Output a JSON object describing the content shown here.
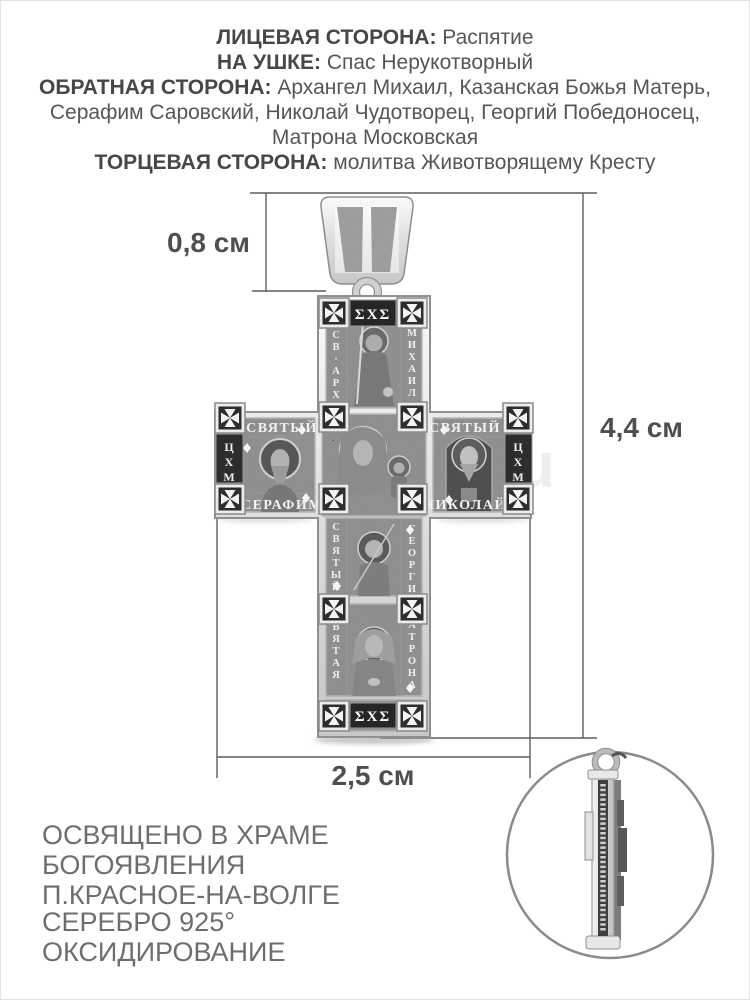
{
  "specs": {
    "lines": [
      {
        "label": "ЛИЦЕВАЯ СТОРОНА:",
        "value": " Распятие"
      },
      {
        "label": "НА УШКЕ:",
        "value": " Спас Нерукотворный"
      },
      {
        "label": "ОБРАТНАЯ СТОРОНА:",
        "value": " Архангел Михаил, Казанская Божья Матерь,"
      },
      {
        "label": "",
        "value": "Серафим Саровский, Николай Чудотворец, Георгий Победоносец,"
      },
      {
        "label": "",
        "value": "Матрона Московская"
      },
      {
        "label": "ТОРЦЕВАЯ СТОРОНА:",
        "value": " молитва Животворящему Кресту"
      }
    ]
  },
  "measurements": {
    "bail_height": "0,8 см",
    "pendant_height": "4,4 см",
    "pendant_width": "2,5 см"
  },
  "pendant": {
    "engravings": {
      "top_emblem": "ΣΧΣ",
      "top_left_vertical": "СВ·АРХ",
      "top_right_vertical": "МИХАИЛ",
      "left_arm_top": "СВЯТЫЙ",
      "left_arm_bottom": "СЕРАФИМ",
      "right_arm_top": "СВЯТЫЙ",
      "right_arm_bottom": "НИКОЛАЙ",
      "left_tip_vertical": "ЦХМ",
      "right_tip_vertical": "ЦХМ",
      "george_left_vertical": "СВЯТЫЙ",
      "george_right_vertical": "ГЕОРГИ",
      "matrona_left_vertical": "СВЯТАЯ",
      "matrona_right_vertical": "МАТРОНА",
      "bottom_emblem": "ΣΧΣ"
    }
  },
  "footer": {
    "blessing_lines": [
      "ОСВЯЩЕНО В ХРАМЕ",
      "БОГОЯВЛЕНИЯ",
      "П.КРАСНОЕ-НА-ВОЛГЕ"
    ],
    "material_lines": [
      "СЕРЕБРО 925°",
      "ОКСИДИРОВАНИЕ"
    ]
  },
  "watermark": "u",
  "colors": {
    "spec_text": "#565656",
    "dimension_text": "#4f4f4f",
    "footer_text": "#6e6e6e",
    "dimension_line": "#5f5f5f",
    "metal_dark": "#333333",
    "metal_light": "#ececec"
  }
}
